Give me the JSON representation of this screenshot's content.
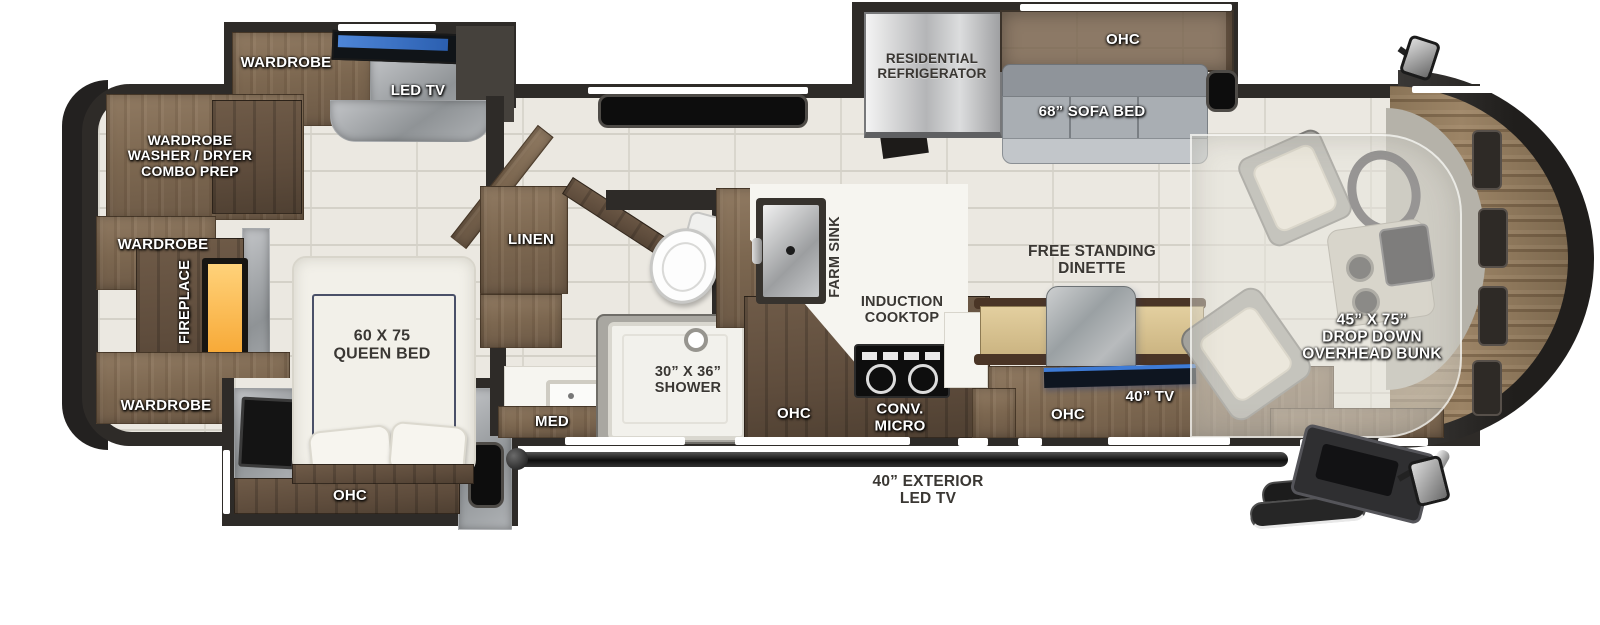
{
  "floorplan": {
    "bedroom": {
      "wardrobe_slide": "WARDROBE",
      "led_tv": "LED TV",
      "washer_dryer_prep": "WARDROBE\nWASHER / DRYER\nCOMBO PREP",
      "wardrobe_side": "WARDROBE",
      "fireplace": "FIREPLACE",
      "wardrobe_front": "WARDROBE",
      "queen_bed": "60 X 75\nQUEEN BED",
      "slide_ohc": "OHC"
    },
    "bathroom": {
      "linen": "LINEN",
      "medicine_cabinet": "MED",
      "shower": "30” X 36”\nSHOWER"
    },
    "kitchen": {
      "farm_sink": "FARM SINK",
      "induction_cooktop": "INDUCTION\nCOOKTOP",
      "convection_microwave": "CONV.\nMICRO",
      "ohc": "OHC"
    },
    "living": {
      "refrigerator": "RESIDENTIAL\nREFRIGERATOR",
      "sofa_ohc": "OHC",
      "sofa_bed": "68” SOFA BED",
      "dinette": "FREE STANDING\nDINETTE",
      "tv": "40” TV",
      "tv_ohc": "OHC"
    },
    "cab": {
      "overhead_bunk": "45” X 75”\nDROP DOWN\nOVERHEAD BUNK"
    },
    "exterior": {
      "led_tv": "40” EXTERIOR\nLED TV"
    }
  }
}
